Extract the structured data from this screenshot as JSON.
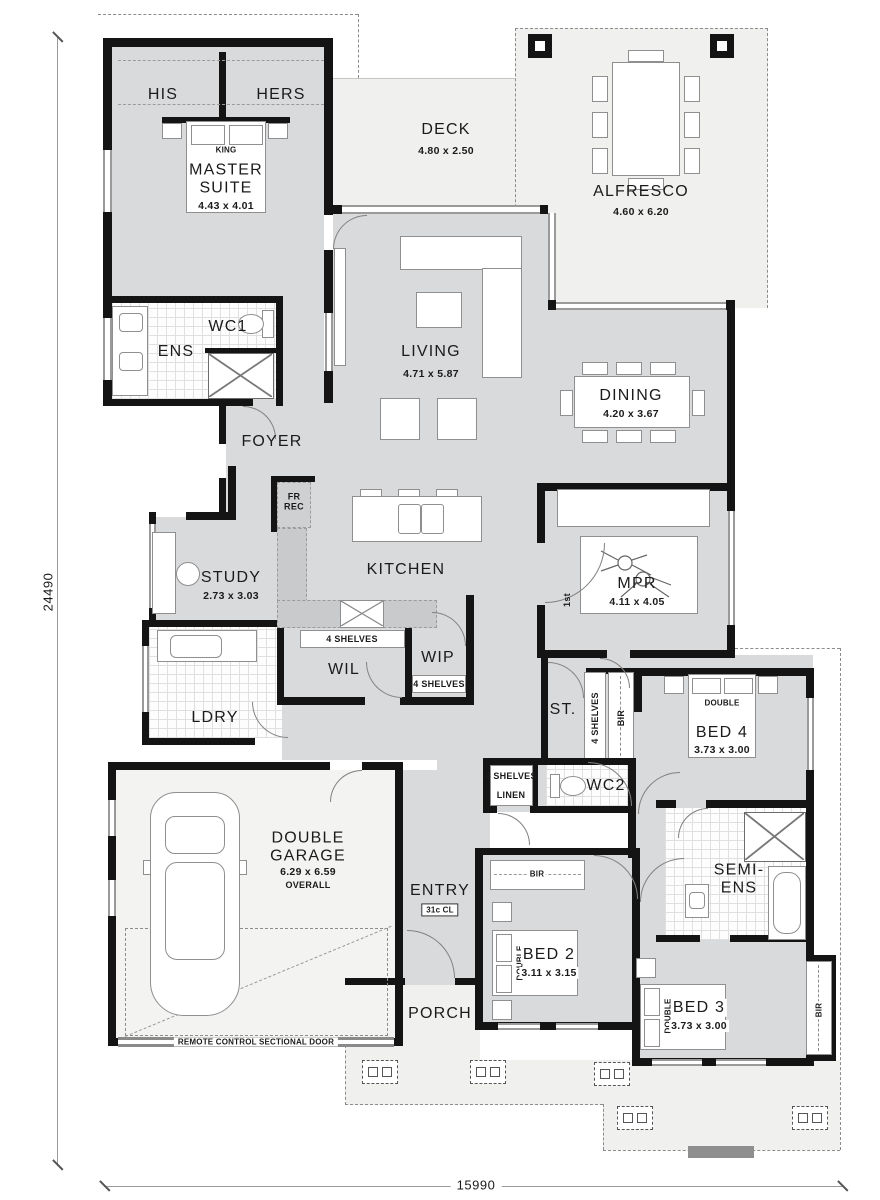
{
  "title": "Single storey home floor plan",
  "colors": {
    "wall": "#141414",
    "floor": "#d9dadb",
    "outdoor": "#f0f0ee",
    "counter": "#c9cacc"
  },
  "rooms": {
    "his": {
      "label": "HIS"
    },
    "hers": {
      "label": "HERS"
    },
    "master": {
      "label": "MASTER\nSUITE",
      "dims": "4.43 x 4.01",
      "bed": "KING"
    },
    "deck": {
      "label": "DECK",
      "dims": "4.80 x 2.50"
    },
    "alfresco": {
      "label": "ALFRESCO",
      "dims": "4.60 x 6.20"
    },
    "living": {
      "label": "LIVING",
      "dims": "4.71 x 5.87"
    },
    "dining": {
      "label": "DINING",
      "dims": "4.20 x 3.67"
    },
    "ens": {
      "label": "ENS"
    },
    "wc1": {
      "label": "WC1"
    },
    "foyer": {
      "label": "FOYER"
    },
    "fridge": {
      "label": "FR\nREC"
    },
    "study": {
      "label": "STUDY",
      "dims": "2.73 x 3.03"
    },
    "kitchen": {
      "label": "KITCHEN"
    },
    "mpr": {
      "label": "MPR",
      "dims": "4.11 x 4.05",
      "door_tag": "1st"
    },
    "wil": {
      "label": "WIL",
      "shelves": "4 SHELVES"
    },
    "wip": {
      "label": "WIP",
      "shelves": "4 SHELVES"
    },
    "ldry": {
      "label": "LDRY"
    },
    "store": {
      "label": "ST.",
      "shelves": "4 SHELVES",
      "bir": "BIR"
    },
    "bed4": {
      "label": "BED 4",
      "dims": "3.73 x 3.00",
      "bed": "DOUBLE"
    },
    "linen": {
      "label": "LINEN",
      "shelves": "4 SHELVES"
    },
    "wc2": {
      "label": "WC2"
    },
    "garage": {
      "label": "DOUBLE\nGARAGE",
      "dims": "6.29 x 6.59",
      "note": "OVERALL",
      "door_note": "REMOTE CONTROL SECTIONAL DOOR"
    },
    "entry": {
      "label": "ENTRY",
      "ceiling": "31c CL"
    },
    "porch": {
      "label": "PORCH"
    },
    "bed2": {
      "label": "BED 2",
      "dims": "3.11 x 3.15",
      "bed": "DOUBLE",
      "bir": "BIR"
    },
    "semi_ens": {
      "label": "SEMI-\nENS"
    },
    "bed3": {
      "label": "BED 3",
      "dims": "3.73 x 3.00",
      "bed": "DOUBLE",
      "bir": "BIR"
    }
  },
  "dimensions": {
    "overall_depth": "24490",
    "overall_width": "15990"
  }
}
